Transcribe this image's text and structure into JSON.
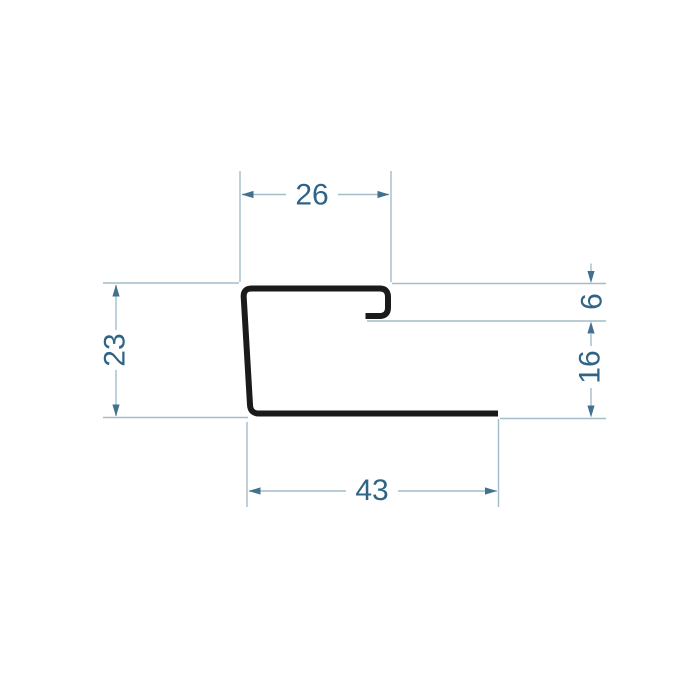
{
  "dimensions": {
    "top_width": "26",
    "lip_opening": "6",
    "hook_to_base": "16",
    "overall_height": "23",
    "base_length": "43"
  },
  "colors": {
    "label_text": "#2f6486",
    "dim_line": "#a3bcc9",
    "arrow": "#41718f",
    "profile": "#1a1a1a",
    "background": "#ffffff"
  }
}
